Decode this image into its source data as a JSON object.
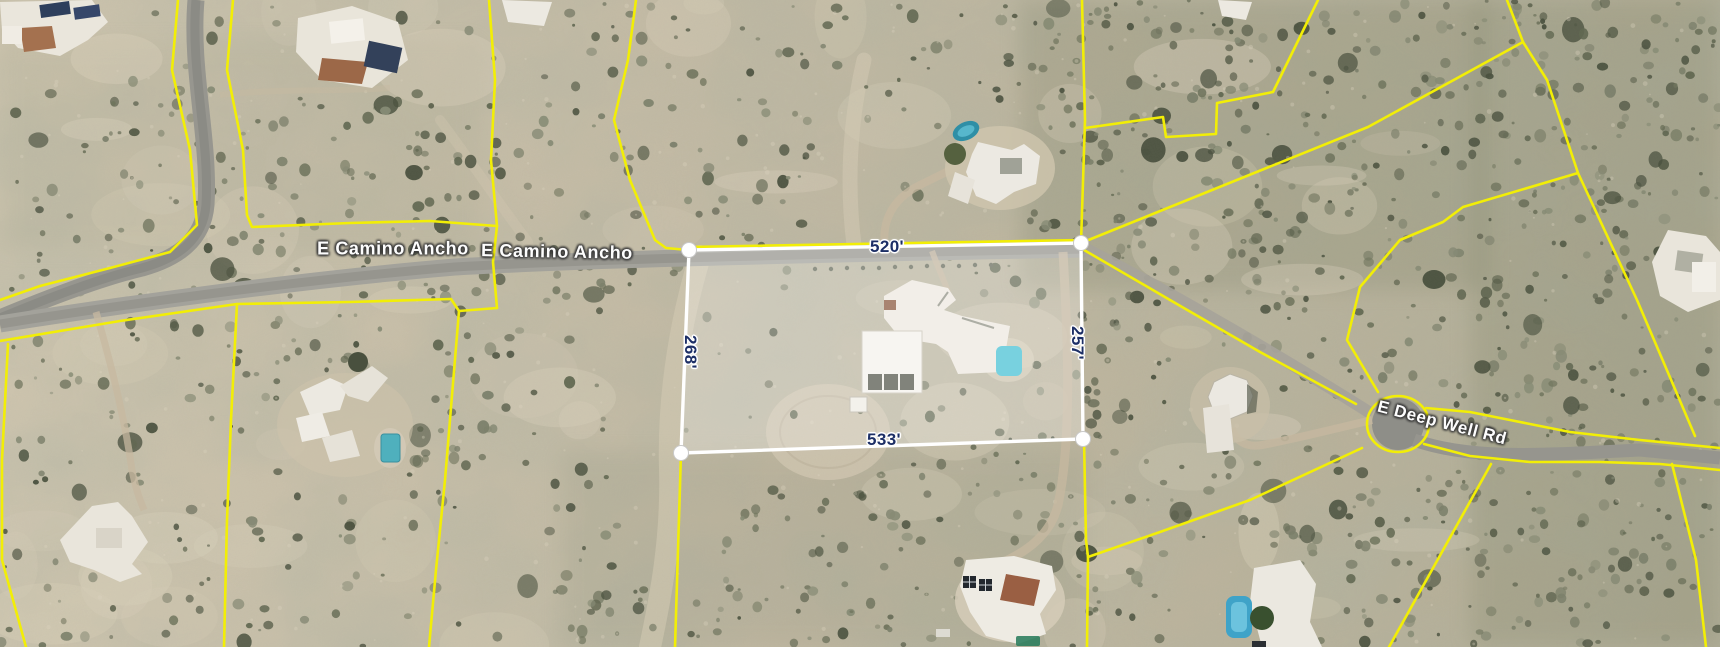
{
  "map": {
    "road_labels": [
      {
        "id": "camino-ancho-1",
        "text": "E Camino Ancho"
      },
      {
        "id": "camino-ancho-2",
        "text": "E Camino Ancho"
      },
      {
        "id": "deep-well-rd",
        "text": "E Deep Well Rd"
      }
    ],
    "selection": {
      "top_length": "520'",
      "right_length": "257'",
      "bottom_length": "533'",
      "left_length": "268'"
    },
    "colors": {
      "parcel_line": "#f2ee06",
      "selection_outline": "#ffffff",
      "dimension_text": "#1d2f66",
      "road_label_text": "#fdfdfd",
      "road_surface": "#a09f97",
      "terrain_base": "#c2b9a3"
    }
  }
}
